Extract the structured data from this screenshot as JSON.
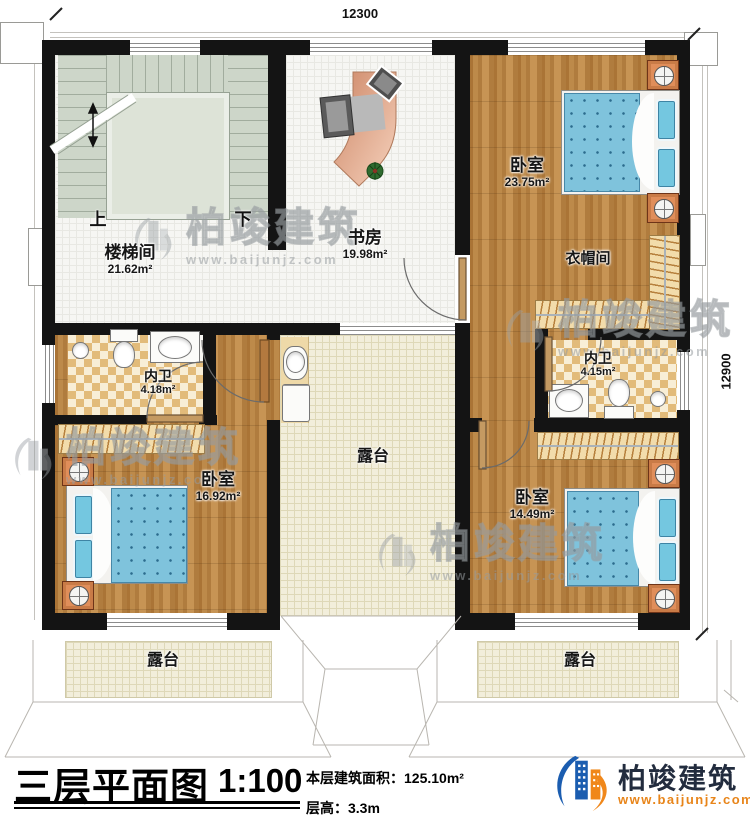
{
  "dimensions": {
    "top": "12300",
    "right": "12900"
  },
  "stairs": {
    "up": "上",
    "down": "下"
  },
  "rooms": {
    "stairwell": {
      "name": "楼梯间",
      "area": "21.62m²"
    },
    "study": {
      "name": "书房",
      "area": "19.98m²"
    },
    "bedroom_ne": {
      "name": "卧室",
      "area": "23.75m²"
    },
    "cloakroom": {
      "name": "衣帽间"
    },
    "bath_left": {
      "name": "内卫",
      "area": "4.18m²"
    },
    "bath_right": {
      "name": "内卫",
      "area": "4.15m²"
    },
    "bedroom_sw": {
      "name": "卧室",
      "area": "16.92m²"
    },
    "bedroom_se": {
      "name": "卧室",
      "area": "14.49m²"
    },
    "terrace_center": {
      "name": "露台"
    },
    "terrace_sw": {
      "name": "露台"
    },
    "terrace_se": {
      "name": "露台"
    }
  },
  "title_block": {
    "title": "三层平面图",
    "scale": "1:100",
    "area_text": "本层建筑面积：125.10m²",
    "height_text": "层高：3.3m"
  },
  "logo": {
    "company": "柏竣建筑",
    "website": "www.baijunjz.com"
  },
  "watermark": {
    "company": "柏竣建筑",
    "website": "www.baijunjz.com"
  },
  "colors": {
    "wall": "#141414",
    "wood": "#b5803f",
    "bed_blue": "#7fc3dc",
    "logo_blue": "#1b5db0",
    "logo_orange": "#f0871a",
    "website_orange": "#e8851a"
  }
}
